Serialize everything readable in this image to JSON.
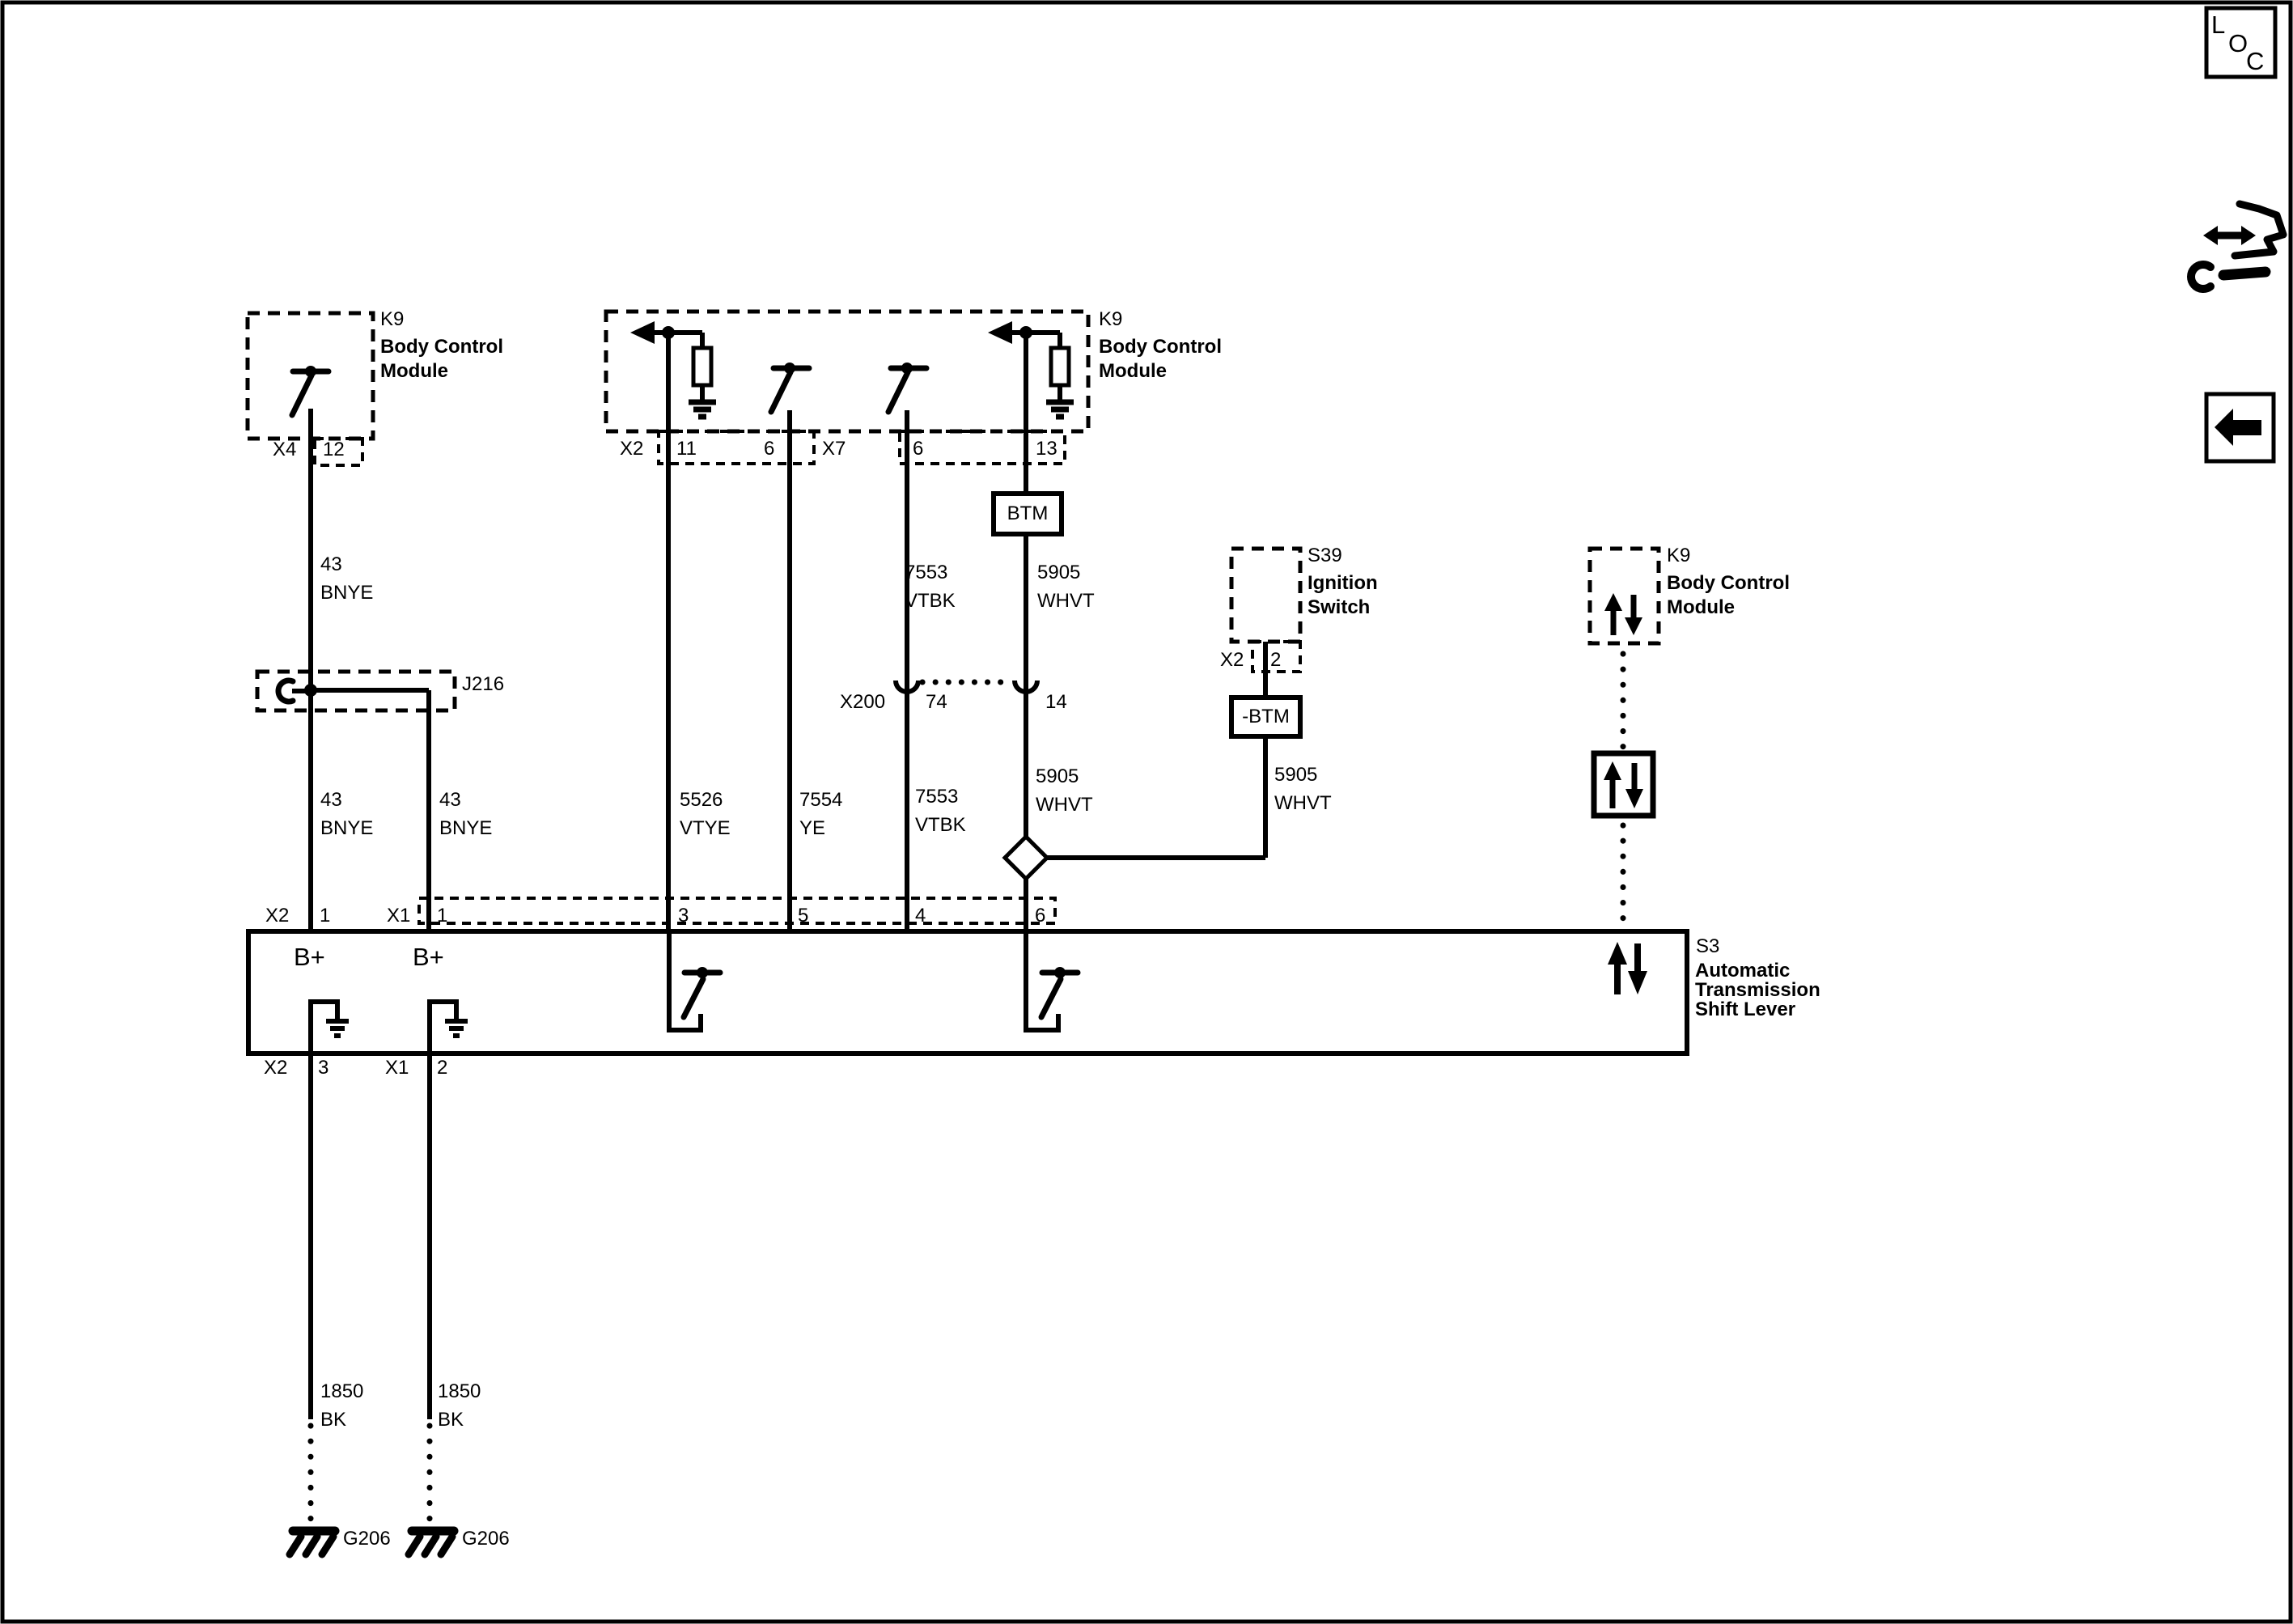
{
  "nav": {
    "loc": {
      "l": "L",
      "o": "O",
      "c": "C"
    },
    "wrench_icon": "harness-repair-icon",
    "back_icon": "back-arrow-icon"
  },
  "components": {
    "bcm_left": {
      "id": "K9",
      "name1": "Body Control",
      "name2": "Module",
      "conn": "X4",
      "pin": "12"
    },
    "bcm_mid": {
      "id": "K9",
      "name1": "Body Control",
      "name2": "Module",
      "conn_a": "X2",
      "pin_11": "11",
      "pin_6a": "6",
      "conn_b": "X7",
      "pin_6b": "6",
      "pin_13": "13"
    },
    "bcm_right": {
      "id": "K9",
      "name1": "Body Control",
      "name2": "Module"
    },
    "ignition": {
      "id": "S39",
      "name1": "Ignition",
      "name2": "Switch",
      "conn": "X2",
      "pin": "2"
    },
    "splice": {
      "id": "J216"
    },
    "conn_x200": {
      "id": "X200",
      "pin_left": "74",
      "pin_right": "14"
    },
    "btm": {
      "label": "BTM"
    },
    "neg_btm": {
      "label": "-BTM"
    },
    "shift": {
      "id": "S3",
      "name1": "Automatic",
      "name2": "Transmission",
      "name3": "Shift Lever",
      "bplus_a": "B+",
      "bplus_b": "B+",
      "top": {
        "conn_a": "X2",
        "pin_a": "1",
        "conn_b": "X1",
        "pin_b": "1",
        "pin_3": "3",
        "pin_5": "5",
        "pin_4": "4",
        "pin_6": "6"
      },
      "bottom": {
        "conn_a": "X2",
        "pin_a": "3",
        "conn_b": "X1",
        "pin_b": "2"
      }
    },
    "ground_a": {
      "id": "G206"
    },
    "ground_b": {
      "id": "G206"
    }
  },
  "wires": {
    "w43_top": {
      "num": "43",
      "color": "BNYE"
    },
    "w43_a": {
      "num": "43",
      "color": "BNYE"
    },
    "w43_b": {
      "num": "43",
      "color": "BNYE"
    },
    "w5526": {
      "num": "5526",
      "color": "VTYE"
    },
    "w7554": {
      "num": "7554",
      "color": "YE"
    },
    "w7553_up": {
      "num": "7553",
      "color": "VTBK"
    },
    "w7553_low": {
      "num": "7553",
      "color": "VTBK"
    },
    "w5905_up": {
      "num": "5905",
      "color": "WHVT"
    },
    "w5905_low": {
      "num": "5905",
      "color": "WHVT"
    },
    "w5905_branch": {
      "num": "5905",
      "color": "WHVT"
    },
    "w1850_a": {
      "num": "1850",
      "color": "BK"
    },
    "w1850_b": {
      "num": "1850",
      "color": "BK"
    }
  },
  "colors": {
    "line": "#000000",
    "background": "#ffffff"
  }
}
